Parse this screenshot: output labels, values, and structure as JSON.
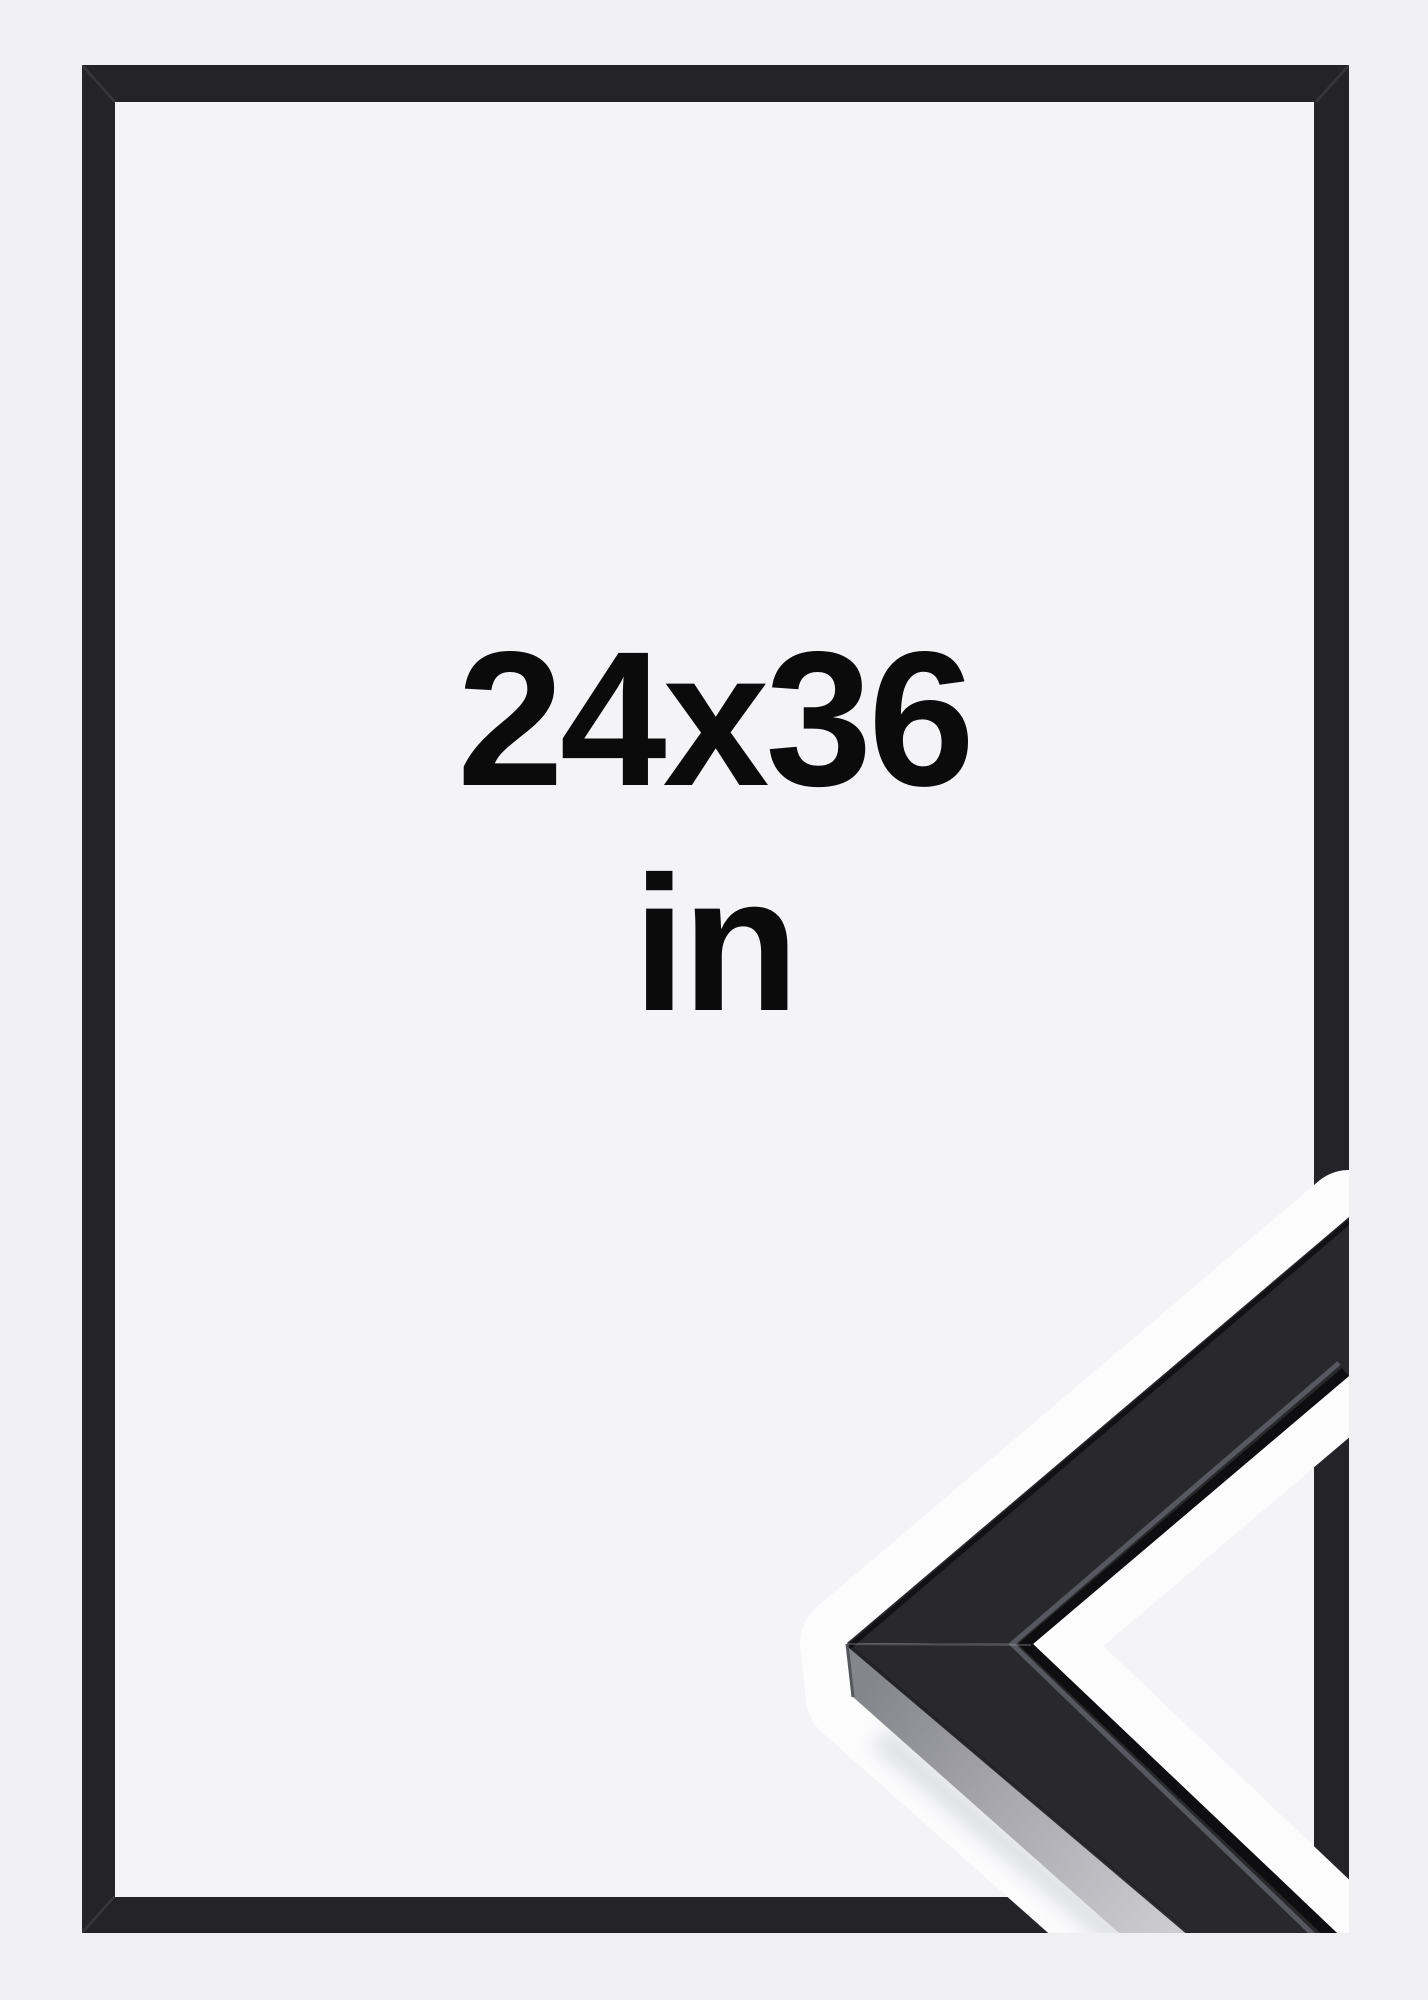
{
  "product": {
    "size_label": "24x36",
    "unit_label": "in"
  },
  "colors": {
    "background": "#f0f0f2",
    "frame_opening": "#f4f4f6",
    "frame_moulding": "#242428",
    "corner_face": "#29292d",
    "corner_side_light": "#cdcdd2",
    "corner_side_dark": "#85858c",
    "halo": "#fcfcfd",
    "text": "#0b0b0b"
  }
}
